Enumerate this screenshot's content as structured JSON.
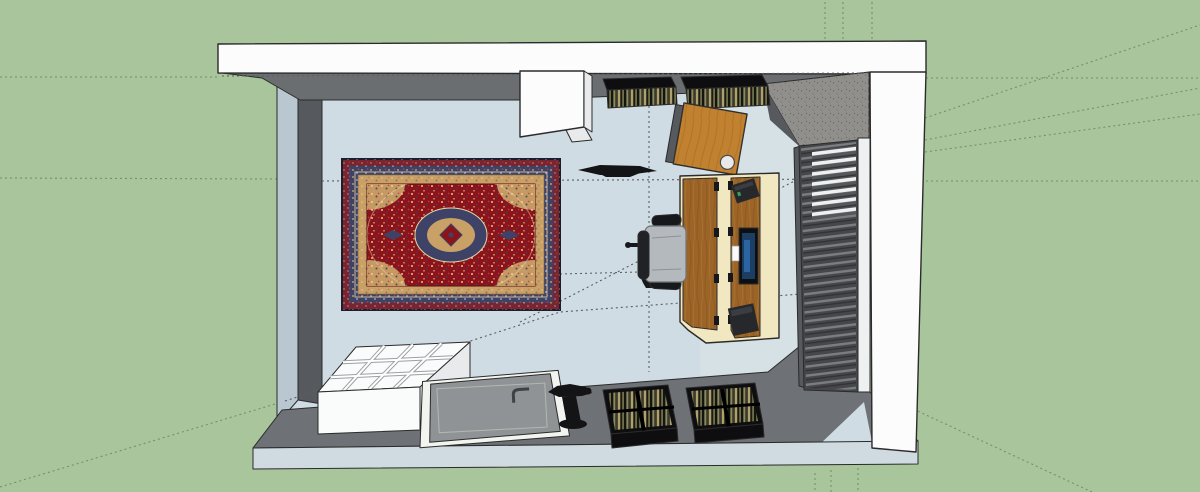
{
  "meta": {
    "title": "3D room model — top-down viewport"
  },
  "palette": {
    "bgGreen": "#a8c59b",
    "guideGreen": "#74906c",
    "guideGray": "#596066",
    "floor": "#cfdce3",
    "floorLight": "#dde6ea",
    "wallWhite": "#fcfcfc",
    "wallLight": "#b9c7d1",
    "wallDark": "#56595e",
    "wallDark2": "#6e7175",
    "wallShadow": "#6b6e71",
    "wallBand": "#cfdbe1",
    "concrete": "#918f8b",
    "blindsBg": "#45474a",
    "blindsSlat": "#7b7e81",
    "blindsGap": "#eef0f1",
    "deskWood": "#9c6426",
    "deskWoodDark": "#7a4d1e",
    "deskCream": "#f1e7c0",
    "tableWood": "#c1812f",
    "rugRed": "#8d131b",
    "rugNavy": "#3d4266",
    "rugTan": "#c9a066",
    "rugMaroon": "#7a2430",
    "rugCream": "#e6d7a5",
    "chairGray": "#b4b9bd",
    "black": "#17181b",
    "speaker": "#26282c",
    "monFrame": "#0d0f12",
    "monScreen": "#1d3e63",
    "monGlow": "#2e6fb0",
    "doorGray": "#8f9396",
    "doorEdge": "#f2f4f0",
    "crate": "#0e0e10",
    "recOlive": "#8a8a5e",
    "recTan": "#b0a06a",
    "recDark": "#23231c",
    "boxWhite": "#fafbfb",
    "boxSide": "#e8eaeb",
    "divider": "#9aa0a4",
    "toolBlack": "#141416",
    "edge": "#2b2b2b"
  },
  "objects": {
    "viewport": {
      "label": "3D modeling viewport — top view of a room"
    },
    "background": {
      "label": "Ground plane"
    },
    "guides": {
      "label": "Construction guide lines"
    },
    "floor": {
      "label": "Room floor"
    },
    "wallTop": {
      "label": "Top wall"
    },
    "wallLeft": {
      "label": "Left wall"
    },
    "wallRight": {
      "label": "Right wall"
    },
    "wallBottom": {
      "label": "Bottom wall"
    },
    "cornerWedge": {
      "label": "Wall corner above window"
    },
    "cabinet": {
      "label": "Wall cabinet"
    },
    "shelfA": {
      "label": "Record shelf 1"
    },
    "shelfB": {
      "label": "Record shelf 2"
    },
    "sideTable": {
      "label": "Leaning table top with cable grommet"
    },
    "wallItem": {
      "label": "Wall-mounted shelf (edge view)"
    },
    "rug": {
      "label": "Persian rug"
    },
    "desk": {
      "label": "Wooden desk"
    },
    "monitor": {
      "label": "Monitor"
    },
    "note": {
      "label": "Sticky note"
    },
    "speakerTop": {
      "label": "Studio speaker (top)"
    },
    "speakerBottom": {
      "label": "Studio speaker (bottom)"
    },
    "chair": {
      "label": "Office chair"
    },
    "blinds": {
      "label": "Window blinds"
    },
    "organizer": {
      "label": "Divided storage bin"
    },
    "door": {
      "label": "Door panel laid flat"
    },
    "tool": {
      "label": "Clamp tool"
    },
    "crateA": {
      "label": "Record crate 1"
    },
    "crateB": {
      "label": "Record crate 2"
    }
  }
}
